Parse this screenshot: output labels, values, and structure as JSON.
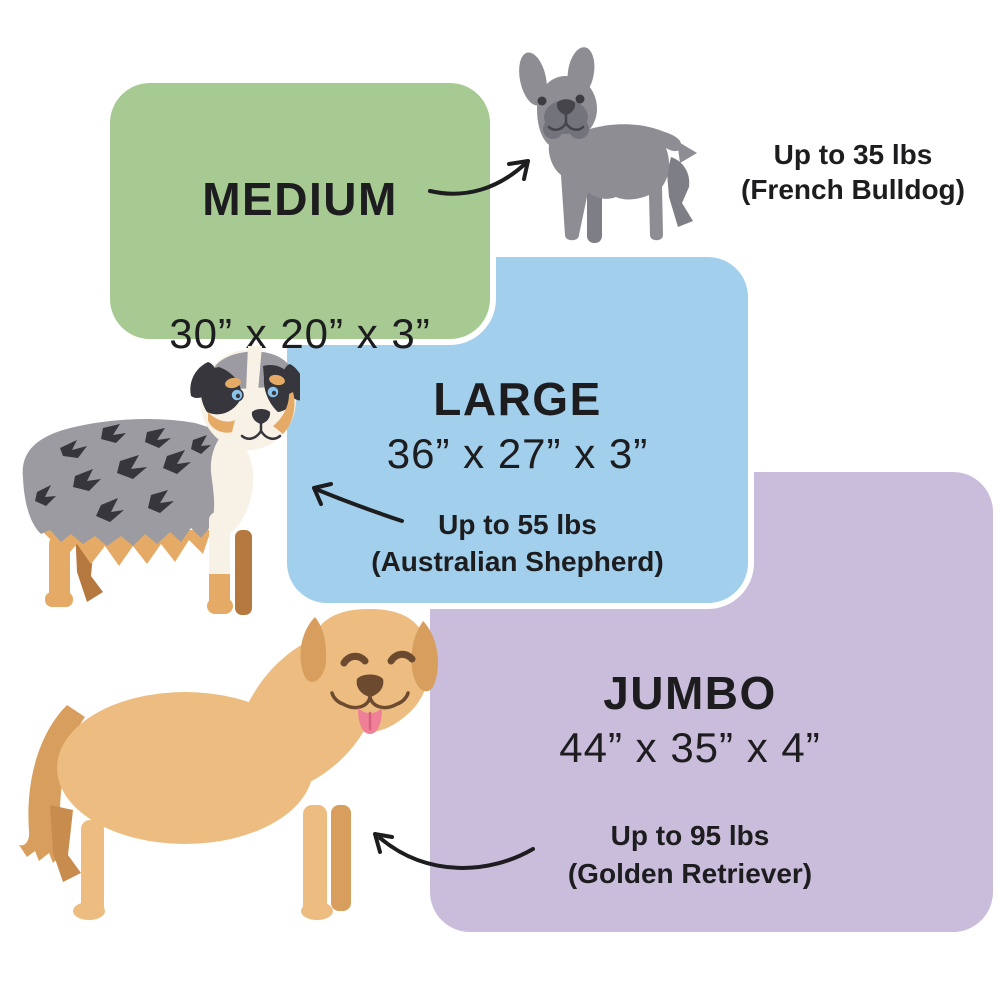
{
  "title": "Dog bed size chart",
  "text_color": "#1d1d1f",
  "sizes": [
    {
      "name": "MEDIUM",
      "dimensions": "30” x 20” x 3”",
      "weight": "Up to 35 lbs",
      "breed": "(French Bulldog)",
      "box_color": "#a6ca92",
      "dog": "french-bulldog"
    },
    {
      "name": "LARGE",
      "dimensions": "36” x 27” x 3”",
      "weight": "Up to 55 lbs",
      "breed": "(Australian Shepherd)",
      "box_color": "#a1cfec",
      "dog": "australian-shepherd"
    },
    {
      "name": "JUMBO",
      "dimensions": "44” x 35” x 4”",
      "weight": "Up to 95 lbs",
      "breed": "(Golden Retriever)",
      "box_color": "#cabddc",
      "dog": "golden-retriever"
    }
  ],
  "illustrations": [
    {
      "name": "french-bulldog",
      "main_color": "#8d8d93"
    },
    {
      "name": "australian-shepherd",
      "main_color": "#9b9ba1"
    },
    {
      "name": "golden-retriever",
      "main_color": "#ecbc80"
    }
  ]
}
